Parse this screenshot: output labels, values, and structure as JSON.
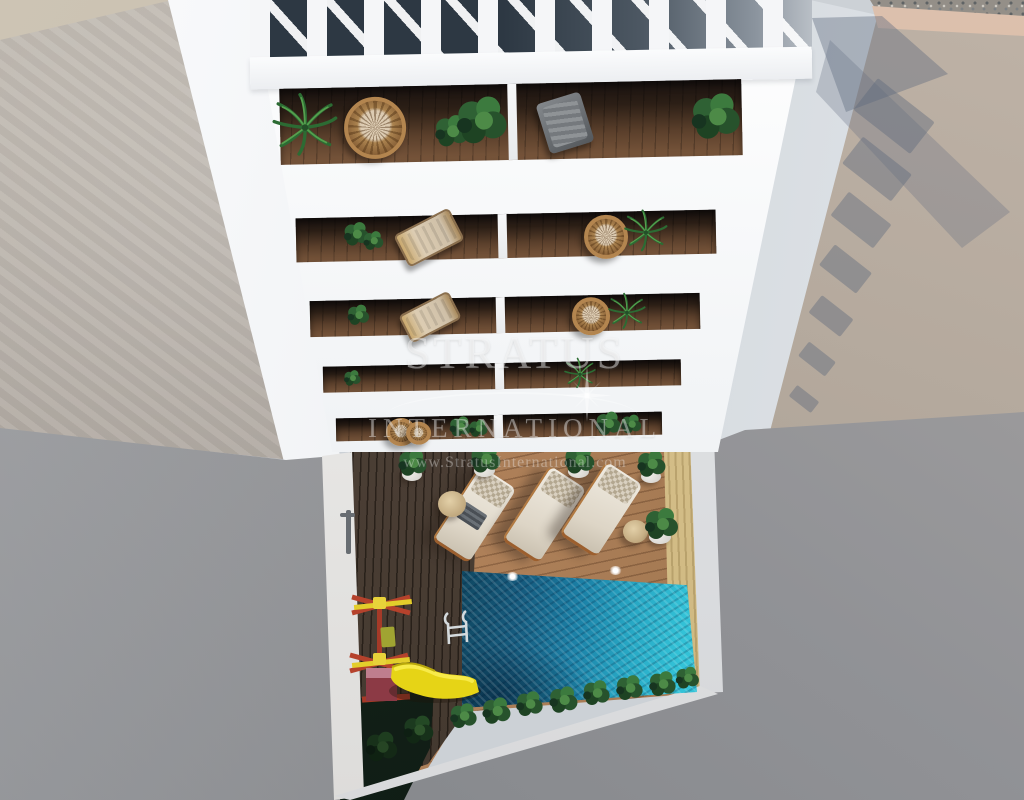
{
  "image": {
    "type": "3D architectural render",
    "view": "top-down aerial view",
    "subject": "White apartment building with rooftop pergola and stacked plant-filled balconies above a courtyard containing a turquoise swimming pool, wooden sun deck with three loungers, and a children's playground with a yellow slide"
  },
  "watermark": {
    "brand": "STRATUS",
    "subtitle": "INTERNATIONAL",
    "url": "www.StratusInternational.com",
    "logo": "compass-star-icon"
  },
  "palette": {
    "building_white": "#f4f5f6",
    "pool_turquoise": "#33c2d7",
    "pool_shadow": "#155a7d",
    "deck_wood": "#b0815a",
    "dark_deck": "#43362b",
    "sand_wall": "#d6c08b",
    "slide_yellow": "#e8d513",
    "playground_red": "#b5422c",
    "plant_green": "#2f6134",
    "wall_gray": "#919296",
    "wall_beige": "#b2a79b"
  }
}
